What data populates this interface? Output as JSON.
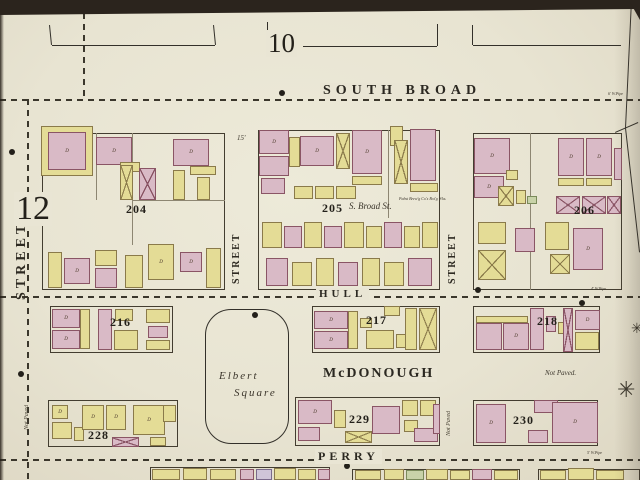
{
  "map": {
    "sheet_number": "10",
    "corner_number": "12",
    "street_labels": [
      {
        "text": "SOUTH  BROAD",
        "x": 320,
        "y": 83,
        "fs": 14,
        "ls": 5
      },
      {
        "text": "HULL",
        "x": 316,
        "y": 288,
        "fs": 11,
        "ls": 4
      },
      {
        "text": "McDONOUGH",
        "x": 320,
        "y": 366,
        "fs": 14,
        "ls": 2
      },
      {
        "text": "PERRY",
        "x": 315,
        "y": 449,
        "fs": 12,
        "ls": 4
      }
    ],
    "vertical_street_labels": [
      {
        "text": "STREET",
        "x": 14,
        "y": 210,
        "len": 100,
        "fs": 14,
        "ls": 4
      },
      {
        "text": "STREET",
        "x": 231,
        "y": 218,
        "len": 80,
        "fs": 10,
        "ls": 2
      },
      {
        "text": "STREET",
        "x": 447,
        "y": 218,
        "len": 80,
        "fs": 10,
        "ls": 2
      }
    ],
    "block_numbers": [
      {
        "text": "204",
        "x": 126,
        "y": 202
      },
      {
        "text": "205",
        "x": 322,
        "y": 201
      },
      {
        "text": "206",
        "x": 574,
        "y": 203
      },
      {
        "text": "216",
        "x": 110,
        "y": 315
      },
      {
        "text": "217",
        "x": 366,
        "y": 313
      },
      {
        "text": "218",
        "x": 537,
        "y": 314
      },
      {
        "text": "228",
        "x": 88,
        "y": 428
      },
      {
        "text": "229",
        "x": 349,
        "y": 412
      },
      {
        "text": "230",
        "x": 513,
        "y": 413
      }
    ],
    "square": {
      "x": 205,
      "y": 309,
      "w": 82,
      "h": 133,
      "line1": "Elbert",
      "line2": "Square"
    },
    "annotations": [
      {
        "text": "S. Broad  St.",
        "x": 349,
        "y": 201,
        "fs": 9,
        "italic": true
      },
      {
        "text": "Not Paved.",
        "x": 545,
        "y": 369,
        "fs": 7,
        "italic": true
      },
      {
        "text": "Pabst Brew'g Co's Bot'g Wks.",
        "x": 399,
        "y": 196,
        "fs": 4,
        "italic": true
      },
      {
        "text": "15'",
        "x": 237,
        "y": 134,
        "fs": 7,
        "italic": true
      },
      {
        "text": "4' W.Pipe",
        "x": 591,
        "y": 286,
        "fs": 4,
        "italic": true
      },
      {
        "text": "5' W.Pipe",
        "x": 587,
        "y": 450,
        "fs": 4,
        "italic": true
      },
      {
        "text": "6' W.Pipe",
        "x": 608,
        "y": 91,
        "fs": 4,
        "italic": true
      }
    ],
    "vertical_annotations": [
      {
        "text": "Not Paved",
        "x": 24,
        "y": 392,
        "len": 50,
        "fs": 6
      },
      {
        "text": "Not Paved",
        "x": 446,
        "y": 398,
        "len": 50,
        "fs": 6
      }
    ],
    "street_dashes": {
      "h": [
        [
          0,
          99,
          640
        ],
        [
          0,
          296,
          640
        ],
        [
          0,
          459,
          640
        ]
      ],
      "v": [
        [
          27,
          99,
          480
        ],
        [
          83,
          13,
          99
        ]
      ]
    },
    "block_outlines": [
      [
        42,
        133,
        183,
        157
      ],
      [
        258,
        130,
        182,
        160
      ],
      [
        473,
        133,
        149,
        157
      ],
      [
        50,
        306,
        123,
        47
      ],
      [
        312,
        306,
        128,
        47
      ],
      [
        473,
        306,
        127,
        47
      ],
      [
        48,
        400,
        130,
        47
      ],
      [
        295,
        397,
        145,
        49
      ],
      [
        473,
        400,
        125,
        46
      ],
      [
        150,
        467,
        180,
        14
      ],
      [
        352,
        469,
        168,
        12
      ],
      [
        538,
        469,
        102,
        12
      ]
    ],
    "lot_lines": [
      [
        132,
        133,
        132,
        245
      ],
      [
        96,
        133,
        96,
        200
      ],
      [
        132,
        200,
        225,
        200
      ],
      [
        388,
        130,
        388,
        218
      ],
      [
        530,
        133,
        530,
        290
      ]
    ],
    "lines": [
      [
        50,
        25,
        52,
        45
      ],
      [
        52,
        45,
        215,
        45
      ],
      [
        215,
        45,
        213,
        25
      ],
      [
        268,
        22,
        268,
        44
      ],
      [
        268,
        44,
        277,
        44
      ],
      [
        303,
        46,
        437,
        46
      ],
      [
        437,
        46,
        437,
        24
      ],
      [
        473,
        25,
        473,
        45
      ],
      [
        473,
        45,
        621,
        45
      ],
      [
        632,
        0,
        626,
        128
      ],
      [
        626,
        128,
        640,
        252
      ],
      [
        615,
        132,
        638,
        122
      ]
    ],
    "dots": [
      [
        282,
        93
      ],
      [
        12,
        152
      ],
      [
        478,
        290
      ],
      [
        255,
        315
      ],
      [
        21,
        374
      ],
      [
        347,
        466
      ],
      [
        582,
        303
      ]
    ],
    "stars": [
      [
        628,
        390,
        22
      ],
      [
        638,
        330,
        14
      ]
    ],
    "buildings": [
      [
        41,
        126,
        52,
        50,
        "y"
      ],
      [
        48,
        132,
        38,
        38,
        "p",
        "D"
      ],
      [
        96,
        137,
        36,
        28,
        "p",
        "D"
      ],
      [
        120,
        162,
        20,
        10,
        "y"
      ],
      [
        120,
        165,
        13,
        35,
        "yx"
      ],
      [
        139,
        168,
        17,
        32,
        "px"
      ],
      [
        173,
        139,
        36,
        27,
        "p",
        "D"
      ],
      [
        190,
        166,
        26,
        9,
        "y"
      ],
      [
        173,
        170,
        12,
        30,
        "y"
      ],
      [
        197,
        177,
        13,
        23,
        "y"
      ],
      [
        48,
        252,
        14,
        36,
        "y"
      ],
      [
        64,
        258,
        26,
        26,
        "p",
        "D"
      ],
      [
        95,
        250,
        22,
        16,
        "y"
      ],
      [
        95,
        268,
        22,
        20,
        "p"
      ],
      [
        125,
        255,
        18,
        33,
        "y"
      ],
      [
        148,
        244,
        26,
        36,
        "y",
        "D"
      ],
      [
        180,
        252,
        22,
        20,
        "p",
        "D"
      ],
      [
        206,
        248,
        15,
        40,
        "y"
      ],
      [
        259,
        130,
        30,
        24,
        "p",
        "D"
      ],
      [
        259,
        156,
        30,
        20,
        "p"
      ],
      [
        261,
        178,
        24,
        16,
        "p"
      ],
      [
        289,
        137,
        11,
        30,
        "y"
      ],
      [
        300,
        136,
        34,
        30,
        "p",
        "D"
      ],
      [
        336,
        133,
        14,
        36,
        "yx"
      ],
      [
        352,
        130,
        30,
        44,
        "p",
        "D"
      ],
      [
        352,
        176,
        30,
        9,
        "y"
      ],
      [
        294,
        186,
        19,
        13,
        "y"
      ],
      [
        315,
        186,
        19,
        13,
        "y"
      ],
      [
        336,
        186,
        20,
        13,
        "y"
      ],
      [
        390,
        126,
        13,
        20,
        "y"
      ],
      [
        394,
        140,
        14,
        44,
        "yx"
      ],
      [
        410,
        129,
        26,
        52,
        "p"
      ],
      [
        410,
        183,
        28,
        9,
        "y"
      ],
      [
        262,
        222,
        20,
        26,
        "y"
      ],
      [
        284,
        226,
        18,
        22,
        "p"
      ],
      [
        304,
        222,
        18,
        26,
        "y"
      ],
      [
        324,
        226,
        18,
        22,
        "p"
      ],
      [
        344,
        222,
        20,
        26,
        "y"
      ],
      [
        366,
        226,
        16,
        22,
        "y"
      ],
      [
        384,
        222,
        18,
        26,
        "p"
      ],
      [
        404,
        226,
        16,
        22,
        "y"
      ],
      [
        422,
        222,
        16,
        26,
        "y"
      ],
      [
        266,
        258,
        22,
        28,
        "p"
      ],
      [
        292,
        262,
        20,
        24,
        "y"
      ],
      [
        316,
        258,
        18,
        28,
        "y"
      ],
      [
        338,
        262,
        20,
        24,
        "p"
      ],
      [
        362,
        258,
        18,
        28,
        "y"
      ],
      [
        384,
        262,
        20,
        24,
        "y"
      ],
      [
        408,
        258,
        24,
        28,
        "p"
      ],
      [
        474,
        138,
        36,
        36,
        "p",
        "D"
      ],
      [
        474,
        176,
        30,
        22,
        "p",
        "D"
      ],
      [
        506,
        170,
        12,
        10,
        "y"
      ],
      [
        498,
        186,
        16,
        20,
        "yx"
      ],
      [
        516,
        190,
        10,
        14,
        "y"
      ],
      [
        527,
        196,
        10,
        8,
        "g"
      ],
      [
        558,
        138,
        26,
        38,
        "p",
        "D"
      ],
      [
        586,
        138,
        26,
        38,
        "p",
        "D"
      ],
      [
        558,
        178,
        26,
        8,
        "y"
      ],
      [
        586,
        178,
        26,
        8,
        "y"
      ],
      [
        556,
        196,
        24,
        18,
        "px"
      ],
      [
        582,
        196,
        24,
        18,
        "px"
      ],
      [
        607,
        196,
        14,
        18,
        "px"
      ],
      [
        614,
        148,
        8,
        32,
        "p"
      ],
      [
        478,
        222,
        28,
        22,
        "y"
      ],
      [
        478,
        250,
        28,
        30,
        "yx"
      ],
      [
        515,
        228,
        20,
        24,
        "p"
      ],
      [
        545,
        222,
        24,
        28,
        "y"
      ],
      [
        573,
        228,
        30,
        42,
        "p",
        "D"
      ],
      [
        550,
        254,
        20,
        20,
        "yx"
      ],
      [
        52,
        309,
        28,
        19,
        "p",
        "D"
      ],
      [
        52,
        330,
        28,
        19,
        "p",
        "D"
      ],
      [
        80,
        309,
        10,
        40,
        "y"
      ],
      [
        98,
        309,
        14,
        41,
        "p"
      ],
      [
        114,
        330,
        24,
        20,
        "y"
      ],
      [
        115,
        309,
        18,
        12,
        "y"
      ],
      [
        146,
        309,
        24,
        14,
        "y"
      ],
      [
        148,
        326,
        20,
        12,
        "p"
      ],
      [
        146,
        340,
        24,
        10,
        "y"
      ],
      [
        314,
        311,
        34,
        18,
        "p",
        "D"
      ],
      [
        314,
        331,
        34,
        18,
        "p",
        "D"
      ],
      [
        348,
        311,
        10,
        38,
        "y"
      ],
      [
        360,
        318,
        12,
        10,
        "y"
      ],
      [
        384,
        306,
        16,
        10,
        "y"
      ],
      [
        366,
        330,
        28,
        19,
        "y"
      ],
      [
        396,
        334,
        16,
        14,
        "y"
      ],
      [
        405,
        308,
        12,
        42,
        "y"
      ],
      [
        419,
        308,
        18,
        42,
        "yx"
      ],
      [
        476,
        316,
        52,
        7,
        "y"
      ],
      [
        476,
        323,
        26,
        27,
        "p"
      ],
      [
        503,
        323,
        26,
        27,
        "p",
        "D"
      ],
      [
        530,
        308,
        14,
        42,
        "p"
      ],
      [
        546,
        316,
        10,
        16,
        "p"
      ],
      [
        558,
        322,
        10,
        12,
        "y"
      ],
      [
        563,
        308,
        10,
        44,
        "px"
      ],
      [
        575,
        310,
        25,
        20,
        "p",
        "D"
      ],
      [
        575,
        332,
        24,
        18,
        "y"
      ],
      [
        52,
        405,
        16,
        14,
        "y",
        "D"
      ],
      [
        52,
        422,
        20,
        17,
        "y"
      ],
      [
        74,
        427,
        10,
        14,
        "y"
      ],
      [
        82,
        405,
        22,
        25,
        "y",
        "D"
      ],
      [
        106,
        405,
        20,
        25,
        "y",
        "D"
      ],
      [
        112,
        437,
        27,
        10,
        "px"
      ],
      [
        133,
        405,
        32,
        30,
        "y",
        "D"
      ],
      [
        150,
        437,
        16,
        9,
        "y"
      ],
      [
        163,
        405,
        13,
        17,
        "y"
      ],
      [
        298,
        400,
        34,
        24,
        "p",
        "D"
      ],
      [
        298,
        427,
        22,
        14,
        "p"
      ],
      [
        334,
        410,
        12,
        18,
        "y"
      ],
      [
        345,
        431,
        27,
        12,
        "yx"
      ],
      [
        372,
        406,
        28,
        28,
        "p"
      ],
      [
        402,
        400,
        16,
        16,
        "y"
      ],
      [
        420,
        400,
        16,
        16,
        "y"
      ],
      [
        404,
        420,
        14,
        12,
        "y"
      ],
      [
        414,
        428,
        24,
        14,
        "p"
      ],
      [
        433,
        404,
        7,
        30,
        "p"
      ],
      [
        476,
        404,
        30,
        39,
        "p",
        "D"
      ],
      [
        534,
        400,
        24,
        13,
        "p"
      ],
      [
        528,
        430,
        20,
        13,
        "p"
      ],
      [
        552,
        402,
        46,
        41,
        "p",
        "D"
      ],
      [
        152,
        469,
        28,
        11,
        "y"
      ],
      [
        183,
        468,
        24,
        12,
        "y"
      ],
      [
        210,
        469,
        26,
        11,
        "y"
      ],
      [
        240,
        469,
        14,
        11,
        "p"
      ],
      [
        256,
        469,
        16,
        11,
        "l"
      ],
      [
        274,
        468,
        22,
        12,
        "y"
      ],
      [
        298,
        469,
        18,
        11,
        "y"
      ],
      [
        318,
        469,
        12,
        11,
        "p"
      ],
      [
        355,
        470,
        26,
        10,
        "y"
      ],
      [
        384,
        469,
        20,
        11,
        "y"
      ],
      [
        406,
        470,
        18,
        10,
        "g"
      ],
      [
        426,
        469,
        22,
        11,
        "y"
      ],
      [
        450,
        470,
        20,
        10,
        "y"
      ],
      [
        472,
        469,
        20,
        11,
        "p"
      ],
      [
        494,
        470,
        24,
        10,
        "y"
      ],
      [
        540,
        470,
        26,
        10,
        "y"
      ],
      [
        568,
        468,
        26,
        12,
        "y"
      ],
      [
        596,
        470,
        28,
        10,
        "y"
      ]
    ]
  }
}
